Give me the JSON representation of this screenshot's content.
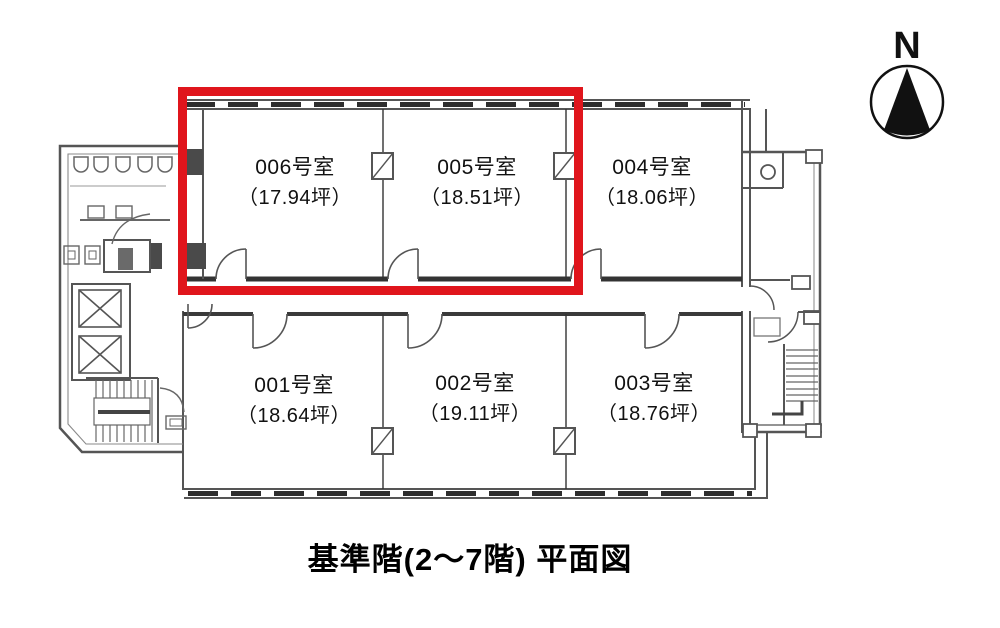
{
  "caption": "基準階(2～7階) 平面図",
  "compass": {
    "label": "N"
  },
  "rooms": [
    {
      "name": "006号室",
      "area": "（17.94坪）",
      "highlighted": true
    },
    {
      "name": "005号室",
      "area": "（18.51坪）",
      "highlighted": true
    },
    {
      "name": "004号室",
      "area": "（18.06坪）",
      "highlighted": false
    },
    {
      "name": "001号室",
      "area": "（18.64坪）",
      "highlighted": false
    },
    {
      "name": "002号室",
      "area": "（19.11坪）",
      "highlighted": false
    },
    {
      "name": "003号室",
      "area": "（18.76坪）",
      "highlighted": false
    }
  ],
  "highlight": {
    "rooms": [
      "006号室",
      "005号室"
    ],
    "color": "#e0151c"
  },
  "icons": {
    "north_arrow": "filled-triangle-in-circle",
    "elevator": "box-with-x-cross",
    "stairs": "hatched-treads",
    "toilet": "circle-fixture"
  },
  "colors": {
    "background": "#ffffff",
    "wall": "#555555",
    "wall_dark": "#2e2e2e",
    "text": "#111111",
    "highlight": "#e0151c"
  }
}
